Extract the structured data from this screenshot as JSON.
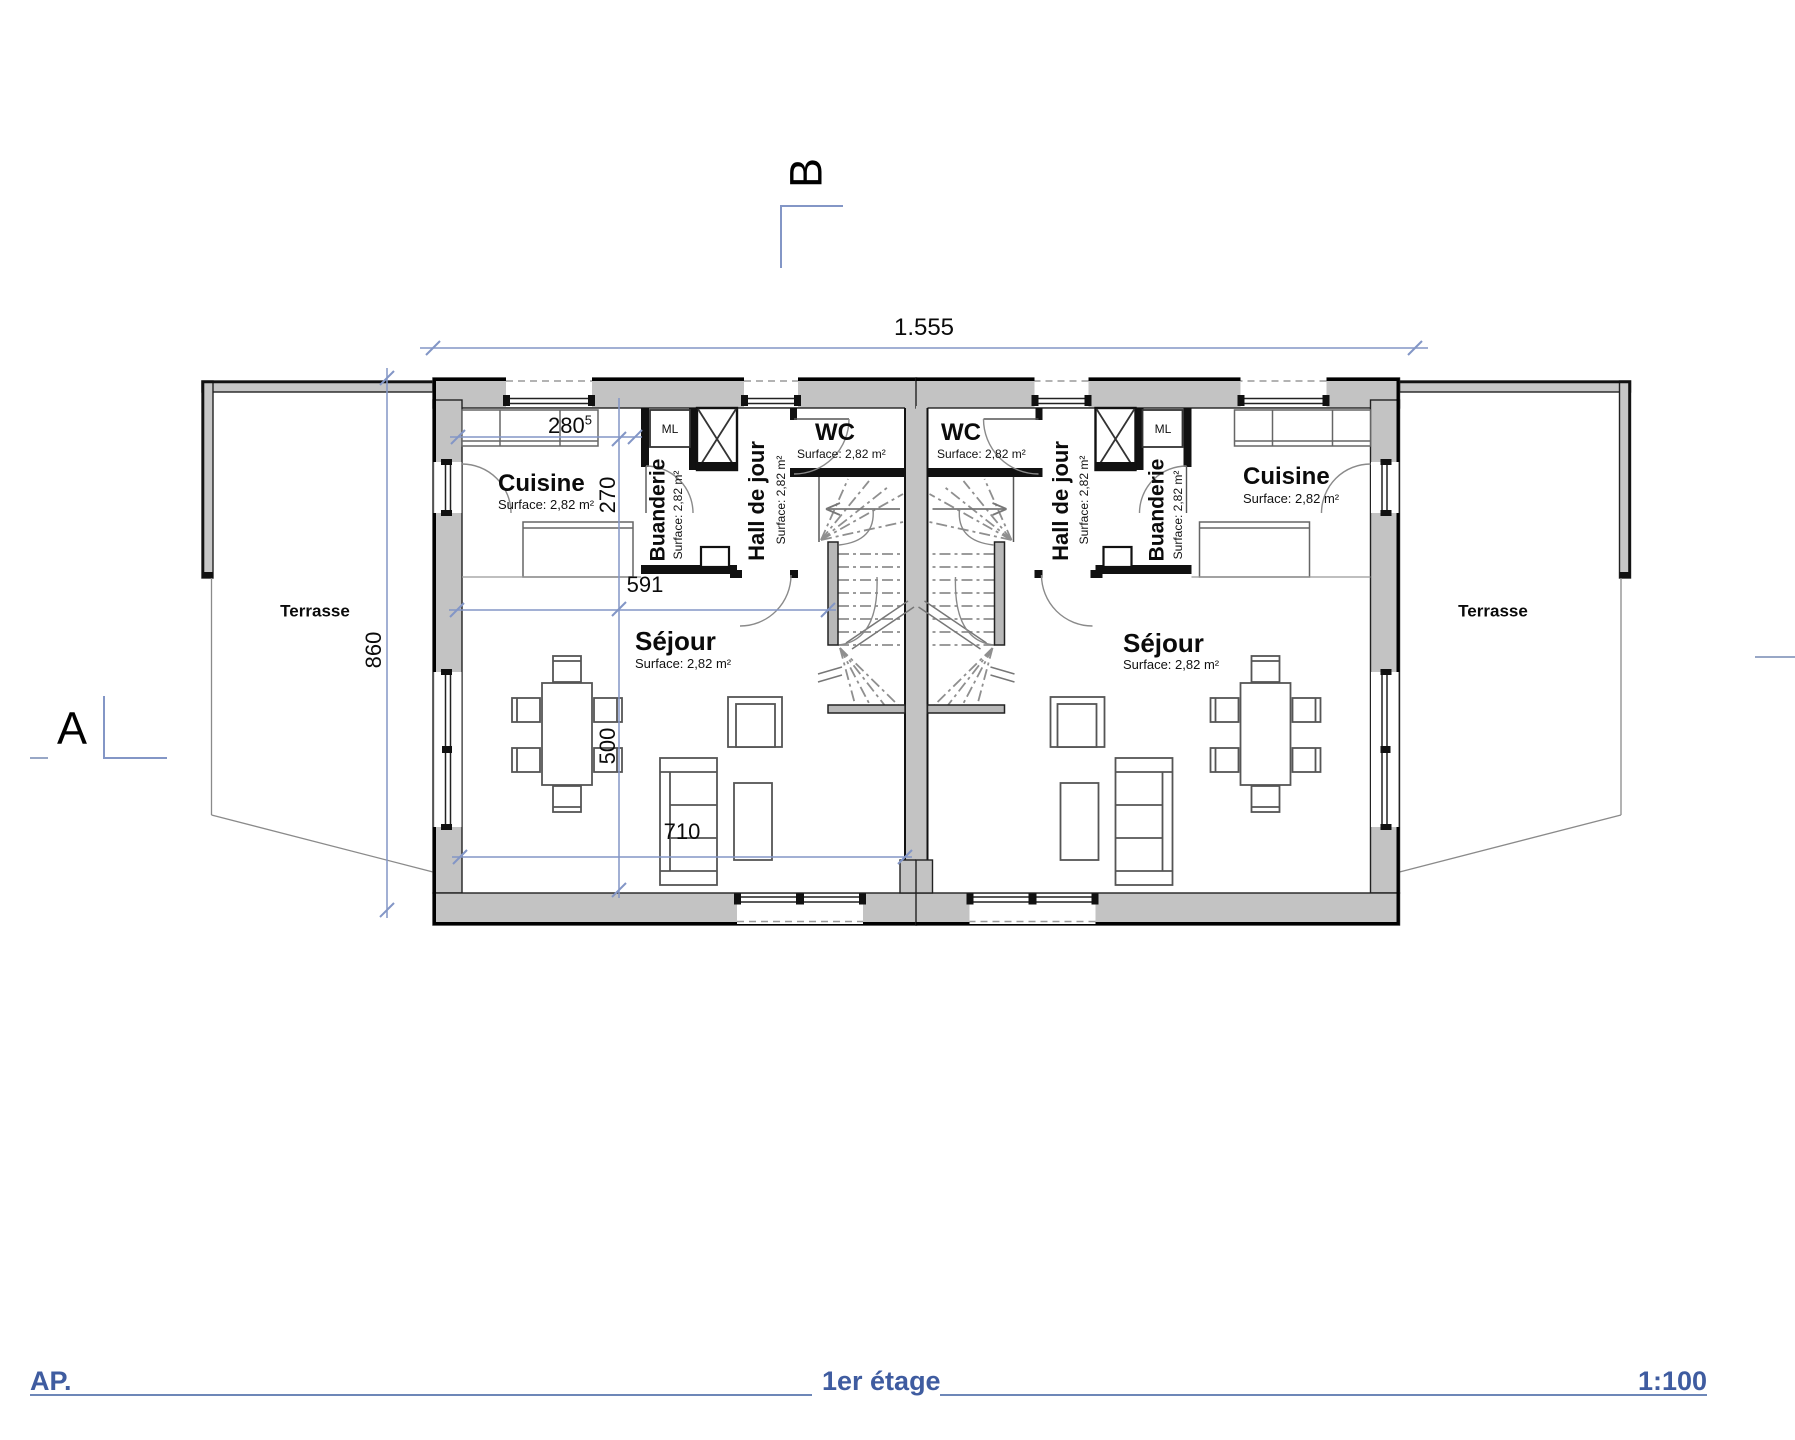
{
  "drawing": {
    "type": "floor-plan",
    "section_markers": {
      "a": "A",
      "b": "B"
    },
    "dimensions": {
      "total_width": "1.555",
      "kitchen_width": "280",
      "kitchen_width_sup": "5",
      "kitchen_depth": "270",
      "living_width": "591",
      "living_depth": "500",
      "living_width_bottom": "710",
      "building_depth": "860"
    },
    "terrace_left": "Terrasse",
    "terrace_right": "Terrasse",
    "unit_left": {
      "kitchen": "Cuisine",
      "kitchen_surface": "Surface: 2,82 m²",
      "laundry": "Buanderie",
      "laundry_surface": "Surface: 2,82 m²",
      "washer": "ML",
      "hall": "Hall de jour",
      "hall_surface": "Surface: 2,82 m²",
      "wc": "WC",
      "wc_surface": "Surface: 2,82 m²",
      "living": "Séjour",
      "living_surface": "Surface: 2,82 m²"
    },
    "unit_right": {
      "kitchen": "Cuisine",
      "kitchen_surface": "Surface: 2,82 m²",
      "laundry": "Buanderie",
      "laundry_surface": "Surface: 2,82 m²",
      "washer": "ML",
      "hall": "Hall de jour",
      "hall_surface": "Surface: 2,82 m²",
      "wc": "WC",
      "wc_surface": "Surface: 2,82 m²",
      "living": "Séjour",
      "living_surface": "Surface: 2,82 m²"
    },
    "title_block": {
      "initials": "AP.",
      "floor": "1er étage",
      "scale": "1:100"
    },
    "colors": {
      "wall_gray": "#c3c3c3",
      "dimension_blue": "#8396c6",
      "footer_blue": "#3f5ca0"
    }
  }
}
